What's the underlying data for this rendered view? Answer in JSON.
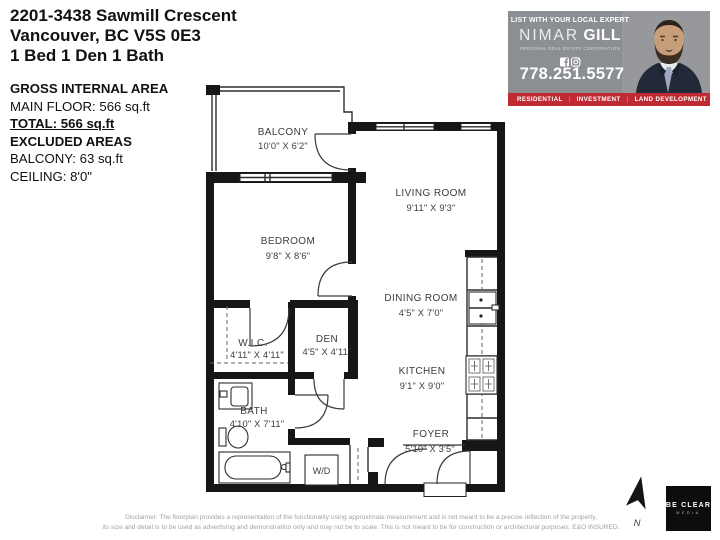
{
  "listing": {
    "title": "2201-3438 Sawmill Crescent",
    "subtitle": "Vancouver, BC V5S 0E3",
    "beds": "1 Bed 1 Den 1 Bath"
  },
  "area_summary": {
    "gross_heading": "GROSS INTERNAL AREA",
    "main_floor": "MAIN FLOOR: 566 sq.ft",
    "total": "TOTAL: 566 sq.ft",
    "excluded_heading": "EXCLUDED AREAS",
    "balcony": "BALCONY: 63 sq.ft",
    "ceiling": "CEILING: 8'0\""
  },
  "agent_ad": {
    "tagline": "LIST WITH YOUR LOCAL EXPERT",
    "first_name": "NIMAR",
    "last_name": "GILL",
    "designation": "PERSONAL REAL ESTATE CORPORATION",
    "phone": "778.251.5577",
    "services": [
      "RESIDENTIAL",
      "INVESTMENT",
      "LAND DEVELOPMENT"
    ],
    "separator": "|",
    "colors": {
      "banner_red": "#C02A33",
      "panel_gray": "#8B8E92"
    },
    "icons": [
      "facebook-icon",
      "instagram-icon"
    ]
  },
  "floor_plan": {
    "rooms": [
      {
        "name": "BALCONY",
        "dims": "10'0\" X 6'2\""
      },
      {
        "name": "LIVING ROOM",
        "dims": "9'11\" X 9'3\""
      },
      {
        "name": "BEDROOM",
        "dims": "9'8\" X 8'6\""
      },
      {
        "name": "DINING ROOM",
        "dims": "4'5\" X 7'0\""
      },
      {
        "name": "W.I.C.",
        "dims": "4'11\" X 4'11\""
      },
      {
        "name": "DEN",
        "dims": "4'5\" X 4'11\""
      },
      {
        "name": "KITCHEN",
        "dims": "9'1\" X 9'0\""
      },
      {
        "name": "BATH",
        "dims": "4'10\" X 7'11\""
      },
      {
        "name": "FOYER",
        "dims": "5'10\" X 3'5\""
      }
    ],
    "washer_dryer": "W/D",
    "north_label": "N"
  },
  "footer": {
    "disclaimer_line1": "Disclaimer: The floorplan provides a representation of the functionality using approximate measurement and is not meant to be a precise reflection of the property,",
    "disclaimer_line2": "its size and detail is to be used as advertising and demonstration only and may not be to scale. This is not meant to be for construction or architectural purposes. E&O INSURED.",
    "logo_primary": "BE CLEAR",
    "logo_secondary": "MEDIA"
  }
}
